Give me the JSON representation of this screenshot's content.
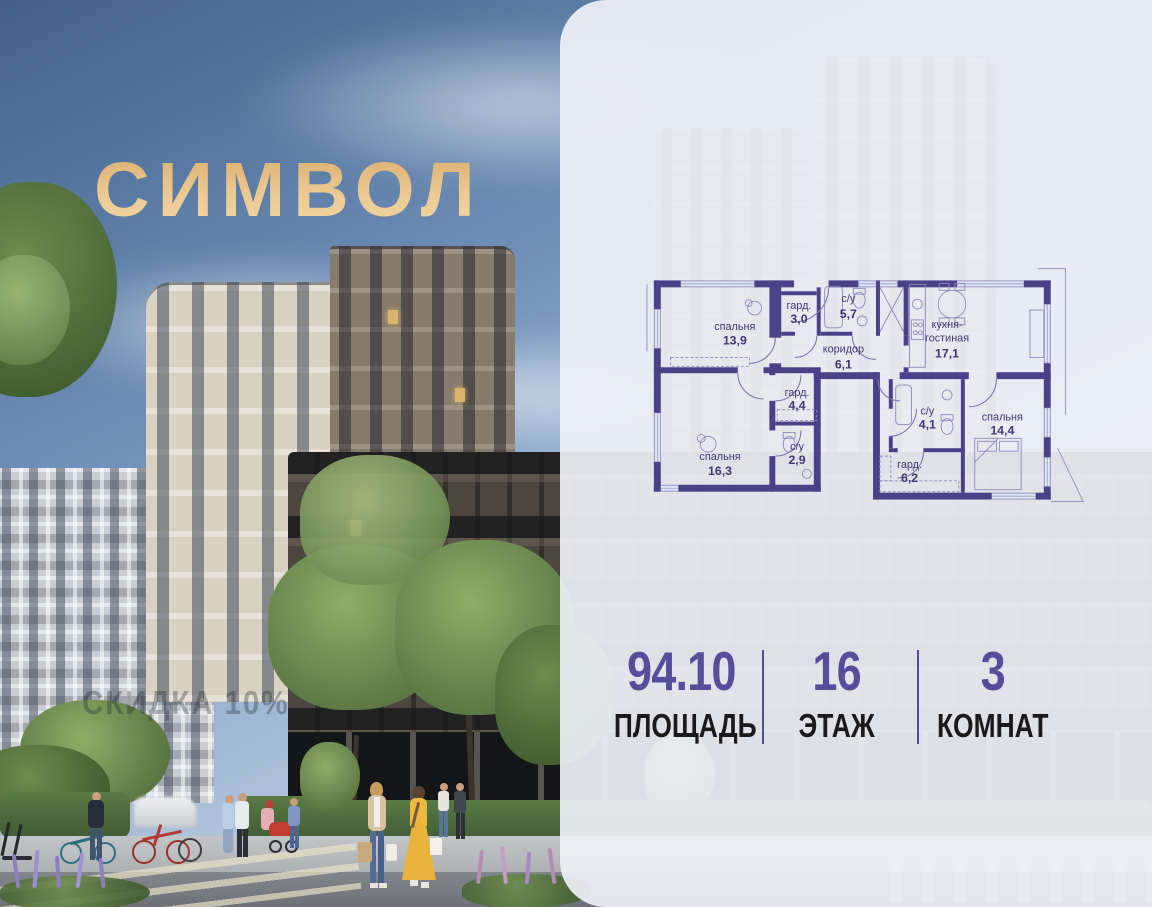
{
  "brand": {
    "logo_text": "СИМВОЛ",
    "logo_color": "#e6c18a"
  },
  "photo": {
    "watermark_text": "СКИДКА 10%"
  },
  "floor_plan": {
    "wall_color": "#4a4189",
    "rooms": [
      {
        "label": "спальня",
        "area": "13,9"
      },
      {
        "label": "гард.",
        "area": "3,0"
      },
      {
        "label": "с/у",
        "area": "5,7"
      },
      {
        "label": "коридор",
        "area": "6,1"
      },
      {
        "label": "кухня-",
        "label2": "гостиная",
        "area": "17,1"
      },
      {
        "label": "гард.",
        "area": "4,4"
      },
      {
        "label": "с/у",
        "area": "2,9"
      },
      {
        "label": "спальня",
        "area": "16,3"
      },
      {
        "label": "с/у",
        "area": "4,1"
      },
      {
        "label": "гард.",
        "area": "6,2"
      },
      {
        "label": "спальня",
        "area": "14,4"
      }
    ]
  },
  "stats": [
    {
      "value": "94.10",
      "label": "ПЛОЩАДЬ"
    },
    {
      "value": "16",
      "label": "ЭТАЖ"
    },
    {
      "value": "3",
      "label": "КОМНАТ"
    }
  ]
}
